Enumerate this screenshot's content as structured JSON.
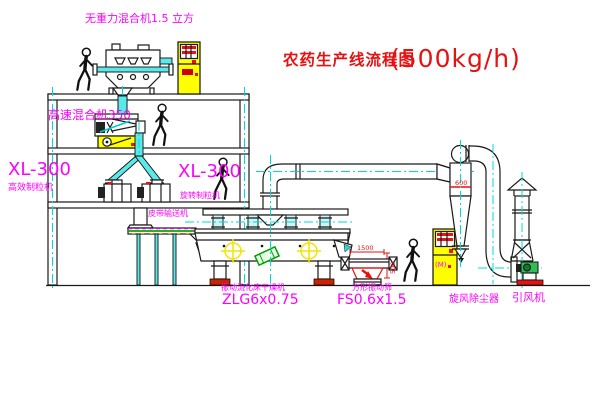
{
  "diagram": {
    "title": {
      "name": "农药生产线流程图",
      "capacity": "(500kg/h)"
    },
    "equipment_labels": {
      "gravity_mixer": "无重力混合机1.5 立方",
      "high_speed_mixer": "高速混合机350",
      "left_granulator_model": "XL-300",
      "left_granulator_name": "高效制粒机",
      "mid_granulator_model": "XL-300",
      "mid_granulator_name": "旋转制粒机",
      "belt_conveyor": "皮带输送机",
      "dryer_name": "振动流化床干燥机",
      "dryer_model": "ZLG6x0.75",
      "screen_name": "方形振动筛",
      "screen_model": "FS0.6x1.5",
      "cyclone_name": "旋风除尘器",
      "fan_name": "引风机",
      "control_cabinet_marking": "(M)"
    },
    "dimensions": {
      "screen_length": "1500",
      "screen_height": "500",
      "cyclone_outlet": "600"
    },
    "colors": {
      "label_magenta": "#ff00ff",
      "title_red": "#e81111",
      "centerline_cyan": "#00d8d8",
      "cabinet_yellow": "#ffff00",
      "base_red": "#cc2200",
      "machine_green": "#33bb55"
    }
  }
}
